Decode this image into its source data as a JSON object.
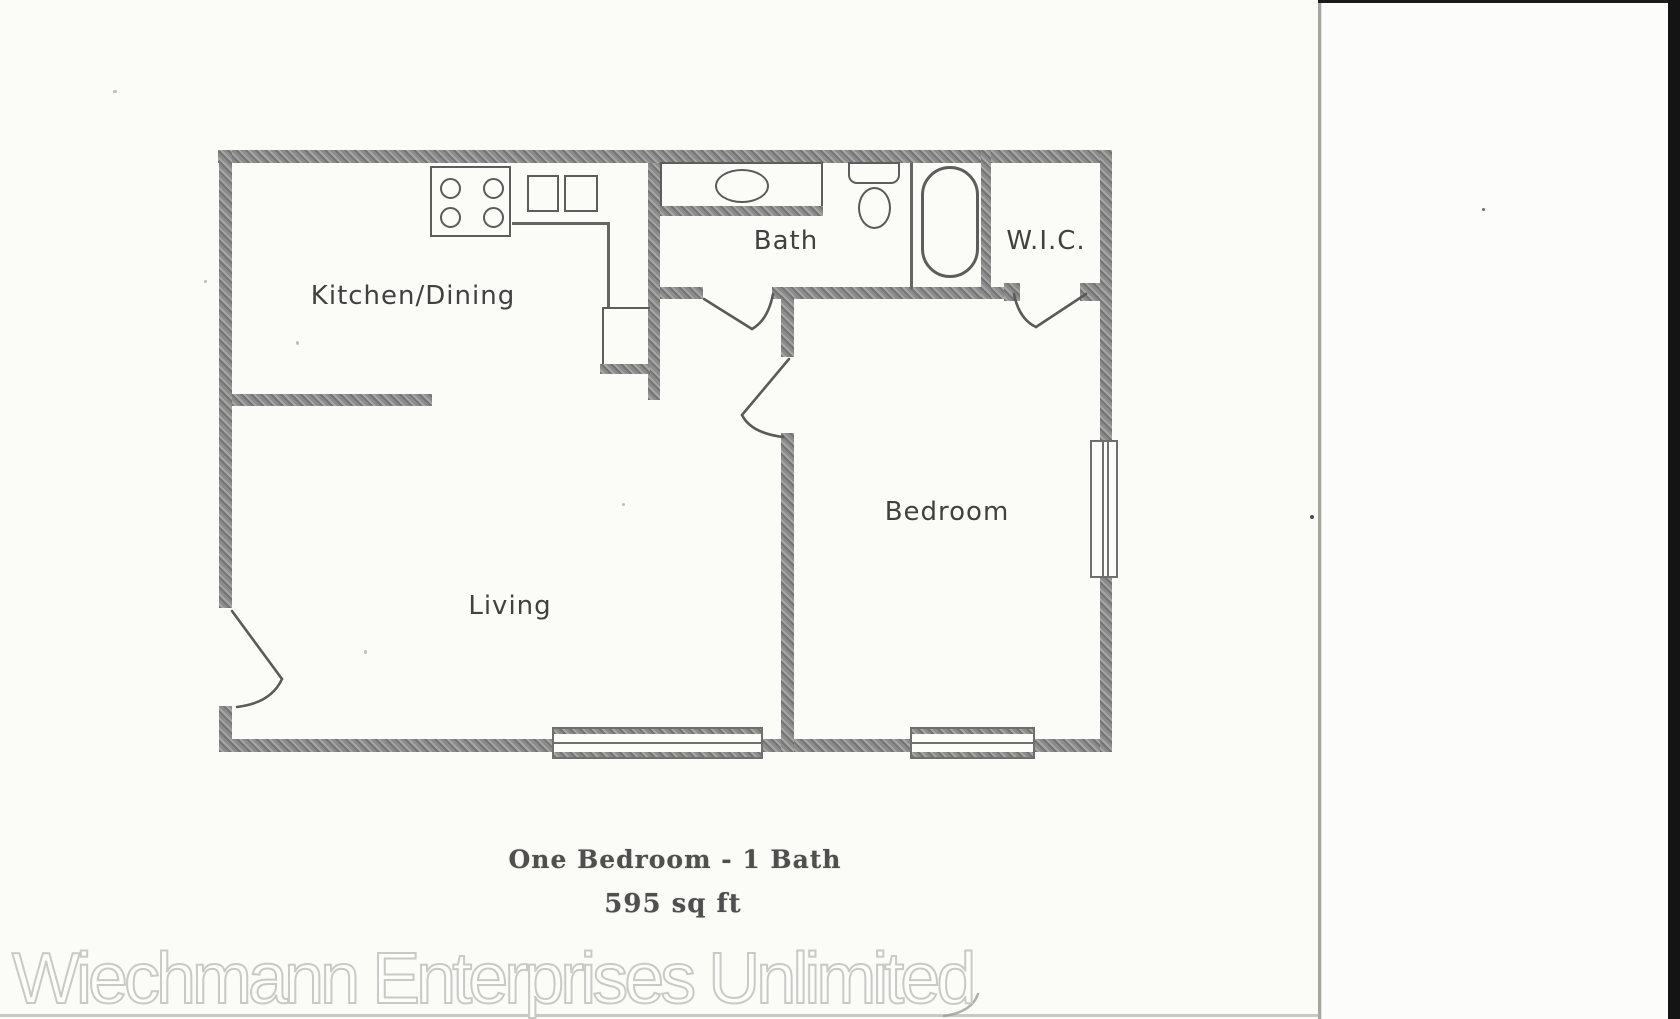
{
  "floor_plan": {
    "rooms": {
      "kitchen_dining": "Kitchen/Dining",
      "bath": "Bath",
      "wic": "W.I.C.",
      "bedroom": "Bedroom",
      "living": "Living"
    },
    "caption": {
      "title": "One Bedroom - 1 Bath",
      "area": "595 sq ft"
    },
    "fixture_names": [
      "stove-icon",
      "double-sink-icon",
      "counter-edge",
      "pantry-closet",
      "vanity-sink-icon",
      "toilet-icon",
      "bathtub-icon",
      "window",
      "door-swing"
    ],
    "colors": {
      "wall": "#8e8e8e",
      "fixture_line": "#5d5d5d",
      "label_text": "#414141",
      "caption_text": "#4f4f4f"
    }
  },
  "watermark": {
    "text": "Wiechmann Enterprises Unlimited",
    "color": "#c9c9c5"
  },
  "scan": {
    "page_color": "#fbfbf7",
    "edge_bar_color": "#141414"
  }
}
